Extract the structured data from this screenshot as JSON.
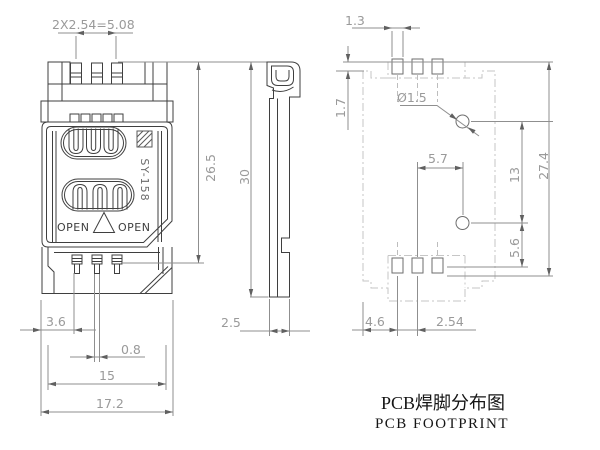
{
  "title": {
    "cn": "PCB焊脚分布图",
    "en": "PCB FOOTPRINT"
  },
  "part": {
    "model": "SY-158",
    "open_left": "OPEN",
    "open_right": "OPEN"
  },
  "dims": {
    "top_pitch": "2X2.54=5.08",
    "front_height": "26.5",
    "front_offset": "3.6",
    "front_pin_w": "0.8",
    "front_inner_w": "15",
    "front_total_w": "17.2",
    "side_height": "30",
    "side_width": "2.5",
    "fp_pad_w": "1.3",
    "fp_pad_h": "1.7",
    "fp_hole_dia": "Ø1.5",
    "fp_hole_dx": "5.7",
    "fp_hole_dy": "13",
    "fp_total_h": "27.4",
    "fp_hole_bot": "5.6",
    "fp_edge_pad": "4.6",
    "fp_pitch": "2.54"
  },
  "colors": {
    "part_line": "#3f3f3f",
    "dim_line": "#8f8f8f",
    "dim_text": "#9a9a9a",
    "footprint_outline": "#c6c6c6",
    "title_text": "#151515",
    "background": "#ffffff"
  }
}
